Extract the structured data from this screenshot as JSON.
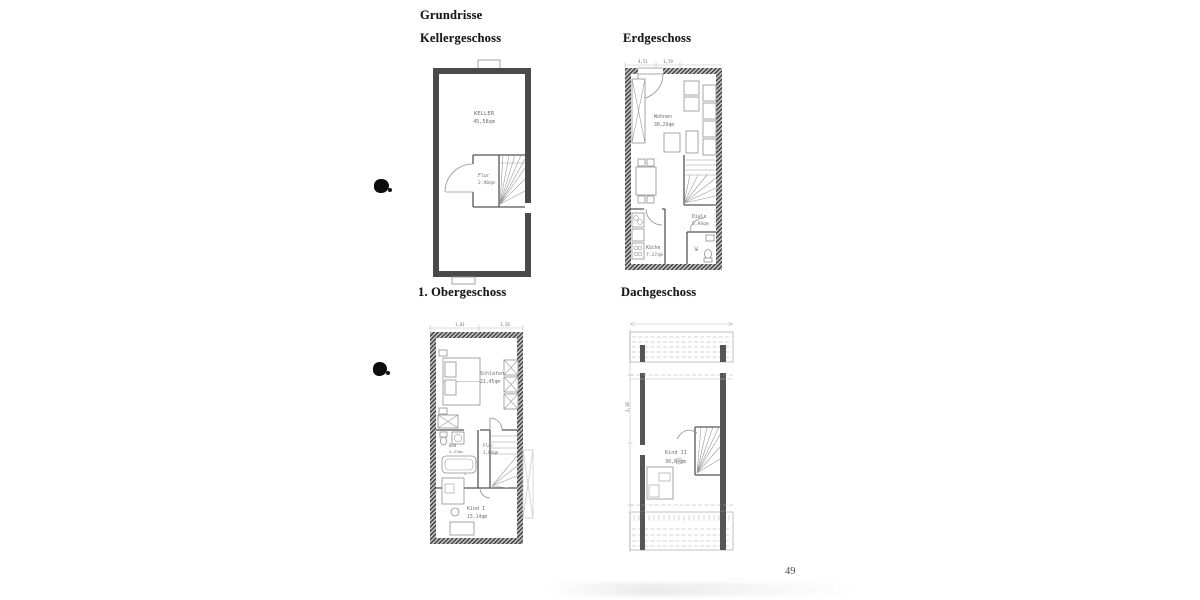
{
  "document": {
    "title": "Grundrisse",
    "page_number": "49"
  },
  "plans": {
    "kellergeschoss": {
      "title": "Kellergeschoss",
      "rooms": {
        "keller": {
          "name": "KELLER",
          "area": "45,58qm"
        },
        "flur": {
          "name": "Flur",
          "area": "2,90qm"
        }
      }
    },
    "erdgeschoss": {
      "title": "Erdgeschoss",
      "dims": {
        "top_left": "4,51",
        "top_right": "1,79"
      },
      "rooms": {
        "wohnen": {
          "name": "Wohnen",
          "area": "30,29qm"
        },
        "diele": {
          "name": "Diele",
          "area": "5,94qm"
        },
        "kueche": {
          "name": "Küche",
          "area": "7,17qm"
        },
        "wc": {
          "name": "WC"
        }
      }
    },
    "obergeschoss": {
      "title": "1. Obergeschoss",
      "dims": {
        "top_left": "1,01",
        "top_right": "1,26",
        "left": "1,06"
      },
      "rooms": {
        "schlafen": {
          "name": "Schlafen",
          "area": "21,45qm"
        },
        "bad": {
          "name": "Bad",
          "area": "5,47qm"
        },
        "flur": {
          "name": "Flur",
          "area": "2,86qm"
        },
        "kind1": {
          "name": "Kind I",
          "area": "15,14qm"
        }
      }
    },
    "dachgeschoss": {
      "title": "Dachgeschoss",
      "dims": {
        "left": "2,18"
      },
      "rooms": {
        "kind2": {
          "name": "Kind II",
          "area": "30,84qm"
        }
      }
    }
  }
}
